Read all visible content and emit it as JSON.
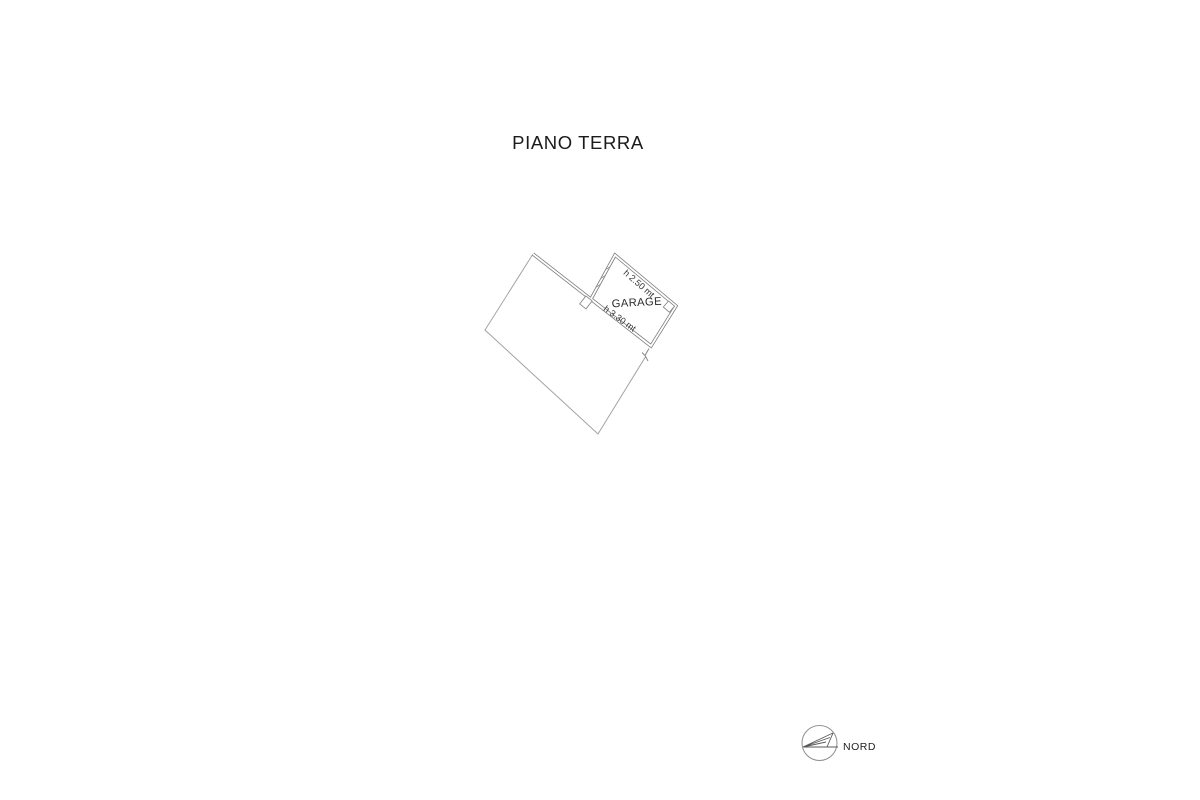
{
  "title": "PIANO TERRA",
  "plan": {
    "room_label": "GARAGE",
    "height_front": "h 2.50 mt",
    "height_back": "h 3.30 mt"
  },
  "compass": {
    "label": "NORD"
  },
  "colors": {
    "background": "#ffffff",
    "outline": "#a3a3a3",
    "wall": "#7d7d7d",
    "label_text": "#2b2b2b",
    "title_text": "#1b1b1b"
  }
}
